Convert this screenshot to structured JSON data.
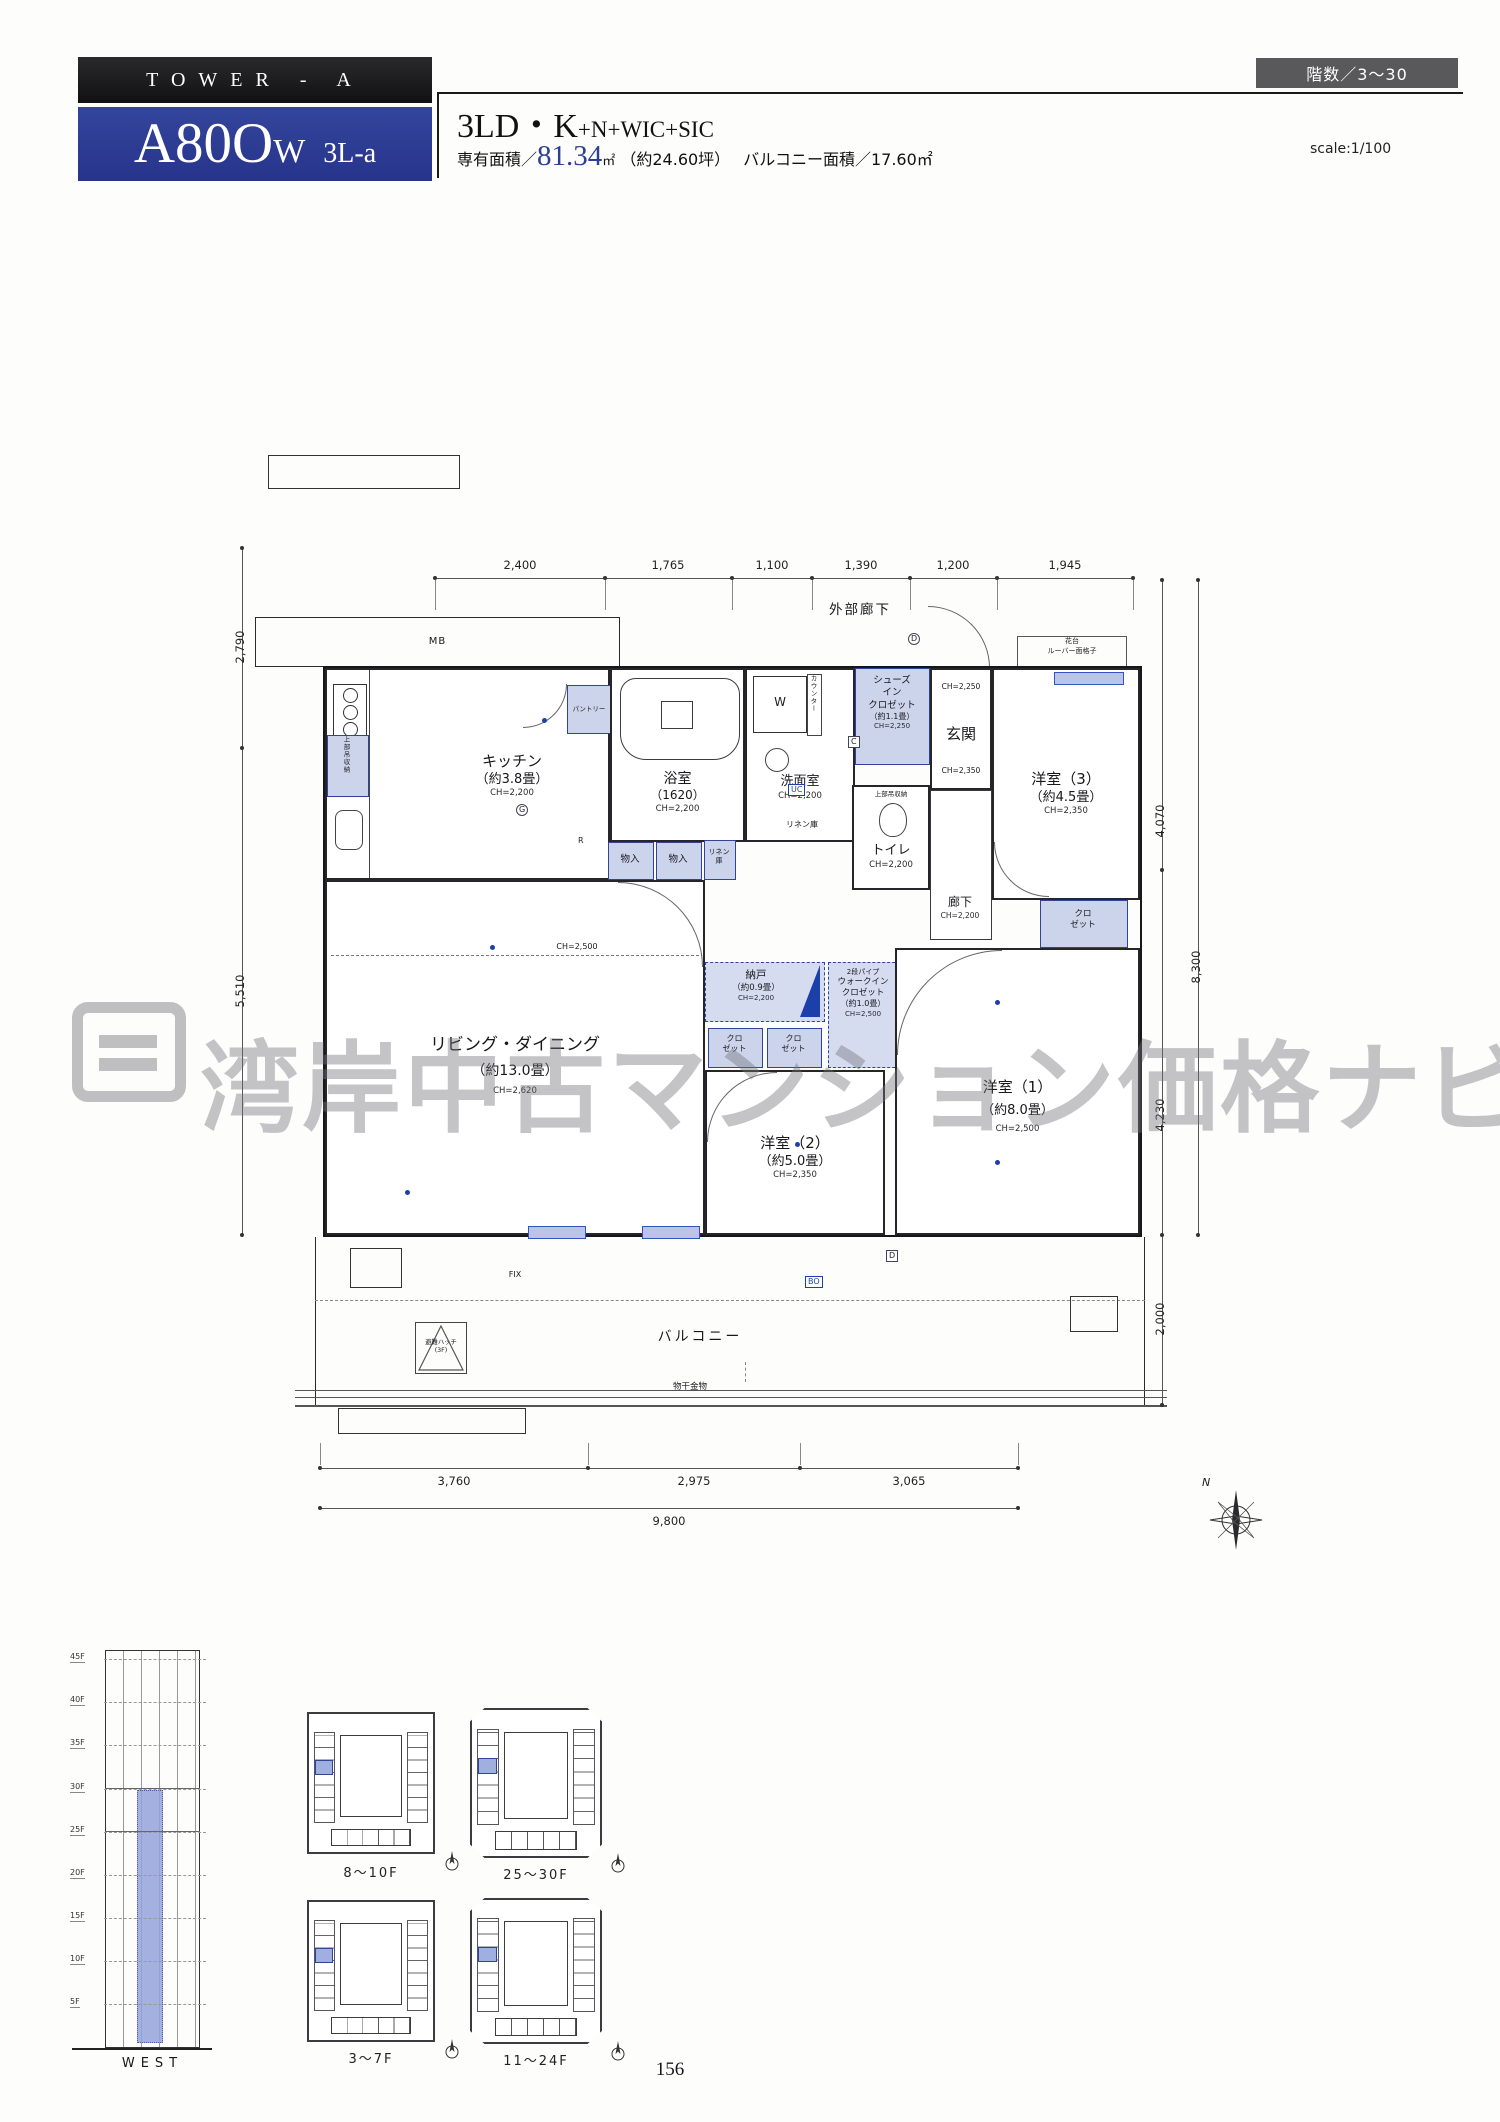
{
  "header": {
    "tower": "TOWER - A",
    "unit_main": "A80O",
    "unit_w": "W",
    "unit_sub": "3L-a",
    "type_main": "3LD・K",
    "type_plus": "+N+WIC+SIC",
    "area_prefix": "専有面積／",
    "area_value": "81.34",
    "area_m2": "㎡",
    "area_tsubo": "（約24.60坪）",
    "balcony": "バルコニー面積／17.60㎡",
    "floors_badge": "階数／3〜30",
    "scale": "scale:1/100"
  },
  "watermark": {
    "text": "湾岸中古マンション価格ナビ"
  },
  "plan": {
    "corridor_label": "外部廊下",
    "mb_label": "MB",
    "dims_top": [
      "2,400",
      "1,765",
      "1,100",
      "1,390",
      "1,200",
      "1,945"
    ],
    "dim_left_upper": "2,790",
    "dim_left_lower": "5,510",
    "dim_right_1": "4,070",
    "dim_right_2": "4,230",
    "dim_right_3": "2,000",
    "dim_right_total": "8,300",
    "dims_bottom": [
      "3,760",
      "2,975",
      "3,065"
    ],
    "dim_bottom_total": "9,800",
    "compass_n": "N",
    "balcony_label": "バルコニー",
    "hatch_1": "避難ハッチ",
    "hatch_2": "(3F)",
    "monohoshi": "物干金物",
    "fix": "FIX",
    "rooms": {
      "kitchen": {
        "name": "キッチン",
        "size": "（約3.8畳）",
        "ch": "CH=2,200"
      },
      "pantry": {
        "name": "パントリー"
      },
      "hanging": {
        "name": "上部吊収納"
      },
      "bath": {
        "name": "浴室",
        "size": "（1620）",
        "ch": "CH=2,200"
      },
      "wash": {
        "name": "洗面室",
        "ch": "CH=2,200",
        "linen_note": "リネン庫"
      },
      "washer": {
        "name": "W"
      },
      "counter": {
        "name": "カウンター"
      },
      "linen": {
        "l1": "リネン",
        "l2": "庫"
      },
      "toilet": {
        "name": "トイレ",
        "ch": "CH=2,200",
        "hanging": "上部吊収納"
      },
      "sic": {
        "l1": "シューズ",
        "l2": "イン",
        "l3": "クロゼット",
        "size": "（約1.1畳）",
        "ch": "CH=2,250"
      },
      "genkan": {
        "name": "玄関",
        "ch_upper": "CH=2,250",
        "ch_lower": "CH=2,350"
      },
      "west3": {
        "name": "洋室（3）",
        "size": "（約4.5畳）",
        "ch": "CH=2,350"
      },
      "hana": {
        "l1": "花台",
        "l2": "ルーバー面格子"
      },
      "hall": {
        "name": "廊下",
        "ch": "CH=2,200"
      },
      "mono": {
        "name": "物入"
      },
      "nando": {
        "name": "納戸",
        "size": "（約0.9畳）",
        "ch": "CH=2,200"
      },
      "wic": {
        "pipe": "2段パイプ",
        "l1": "ウォークイン",
        "l2": "クロゼット",
        "size": "（約1.0畳）",
        "ch": "CH=2,500"
      },
      "closet_small": {
        "l1": "クロ",
        "l2": "ゼット"
      },
      "living": {
        "name": "リビング・ダイニング",
        "size": "（約13.0畳）",
        "ch": "CH=2,620",
        "soffit": "CH=2,500"
      },
      "west2": {
        "name": "洋室（2）",
        "size": "（約5.0畳）",
        "ch": "CH=2,350"
      },
      "west1": {
        "name": "洋室（1）",
        "size": "（約8.0畳）",
        "ch": "CH=2,500"
      }
    },
    "fixtures": {
      "d": "D",
      "c": "C",
      "uc": "UC",
      "g": "G",
      "r": "R",
      "bo": "BO"
    }
  },
  "elevation": {
    "floors": [
      "45F",
      "40F",
      "35F",
      "30F",
      "25F",
      "20F",
      "15F",
      "10F",
      "5F"
    ],
    "caption": "WEST"
  },
  "mini_plans": [
    {
      "label": "8〜10F"
    },
    {
      "label": "25〜30F"
    },
    {
      "label": "3〜7F"
    },
    {
      "label": "11〜24F"
    }
  ],
  "page_number": "156"
}
